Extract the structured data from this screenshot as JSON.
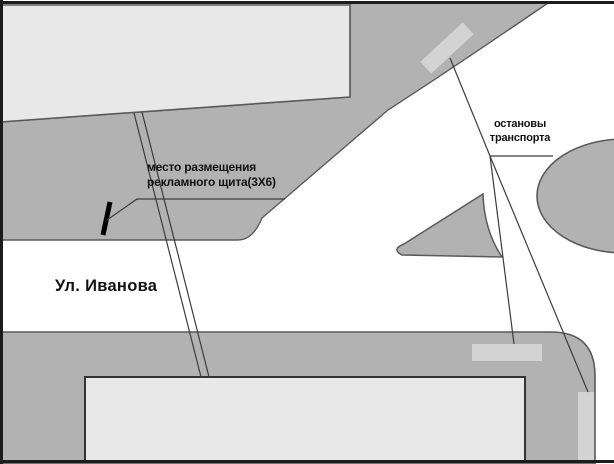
{
  "map": {
    "street_label": "Ул. Иванова",
    "billboard_label": {
      "line1": "место размещения",
      "line2": "рекламного щита(3Х6)"
    },
    "stops_label": {
      "line1": "остановы",
      "line2": "транспорта"
    }
  },
  "colors": {
    "area-dark": "#b2b2b2",
    "area-light": "#e8e8e8",
    "stop-marker": "#d3d3d3",
    "outline": "#5a5a5a",
    "line": "#3c3c3c",
    "frame": "#1c1c1c",
    "text": "#111111",
    "background": "#ffffff"
  }
}
